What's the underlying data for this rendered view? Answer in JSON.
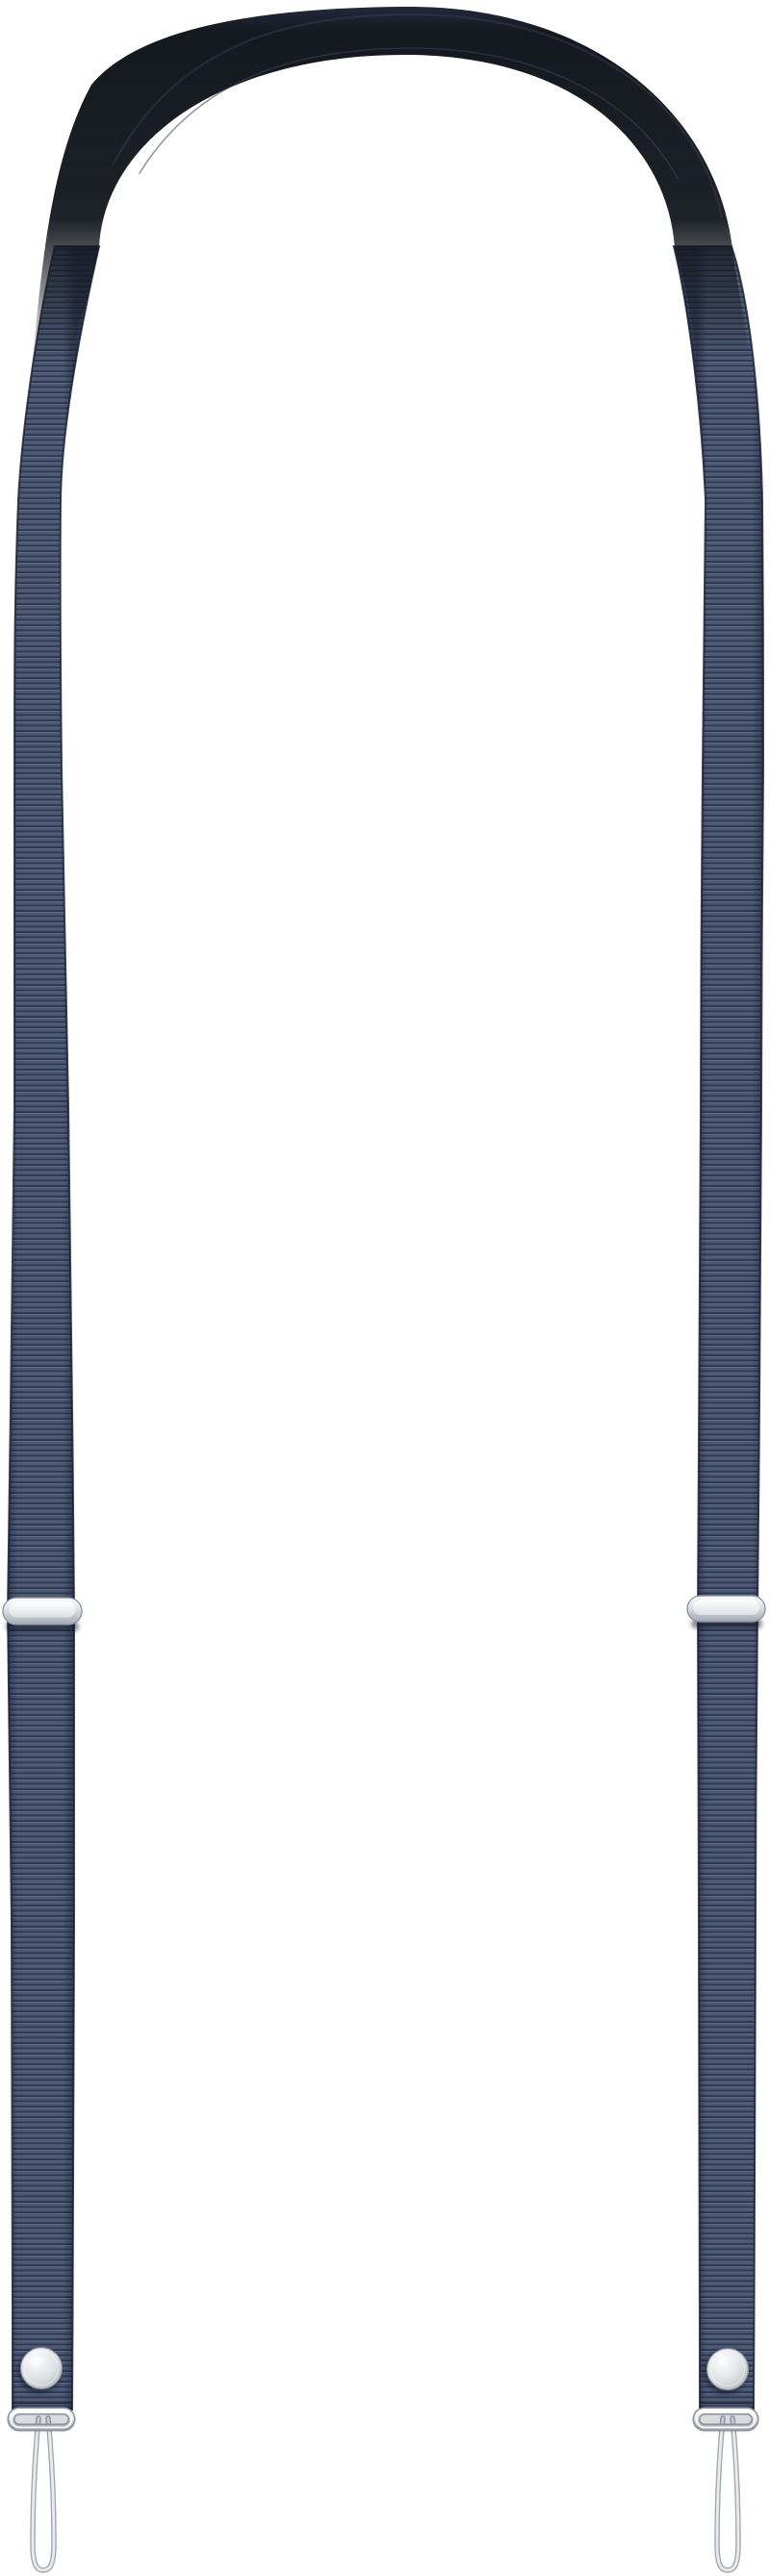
{
  "image": {
    "type": "product-photo",
    "background": "#ffffff",
    "subject": "Dark slate-blue fabric lanyard strap with padded top section, silver metal slider adjusters, snap buttons, wire end loops and cord attachment loops"
  },
  "colors": {
    "background": "#ffffff",
    "webbing_base": "#4c5872",
    "webbing_rib_dark": "#2f3950",
    "webbing_rib_light": "#5f6c88",
    "webbing_edge": "#161d31",
    "pad_top": "#272d43",
    "pad_dark": "#14181f",
    "pad_seam": "#3a4157",
    "metal_border": "#8b919b",
    "metal_bright": "#ffffff",
    "metal_mid": "#dcdfe3",
    "metal_shade": "#a4a9b1",
    "cord_dark": "#a2a7ae",
    "cord_light": "#e9ebed",
    "shadow": "#10162a"
  },
  "parts": {
    "top_pad": "padded-shoulder-section",
    "left_strap": "ribbed-webbing-strap",
    "right_strap": "ribbed-webbing-strap",
    "left_adjuster": "metal-slider-buckle",
    "right_adjuster": "metal-slider-buckle",
    "left_snap": "metal-snap-button",
    "right_snap": "metal-snap-button",
    "left_wire_loop": "metal-end-loop",
    "right_wire_loop": "metal-end-loop",
    "left_cord_loop": "cord-attachment-loop",
    "right_cord_loop": "cord-attachment-loop"
  }
}
